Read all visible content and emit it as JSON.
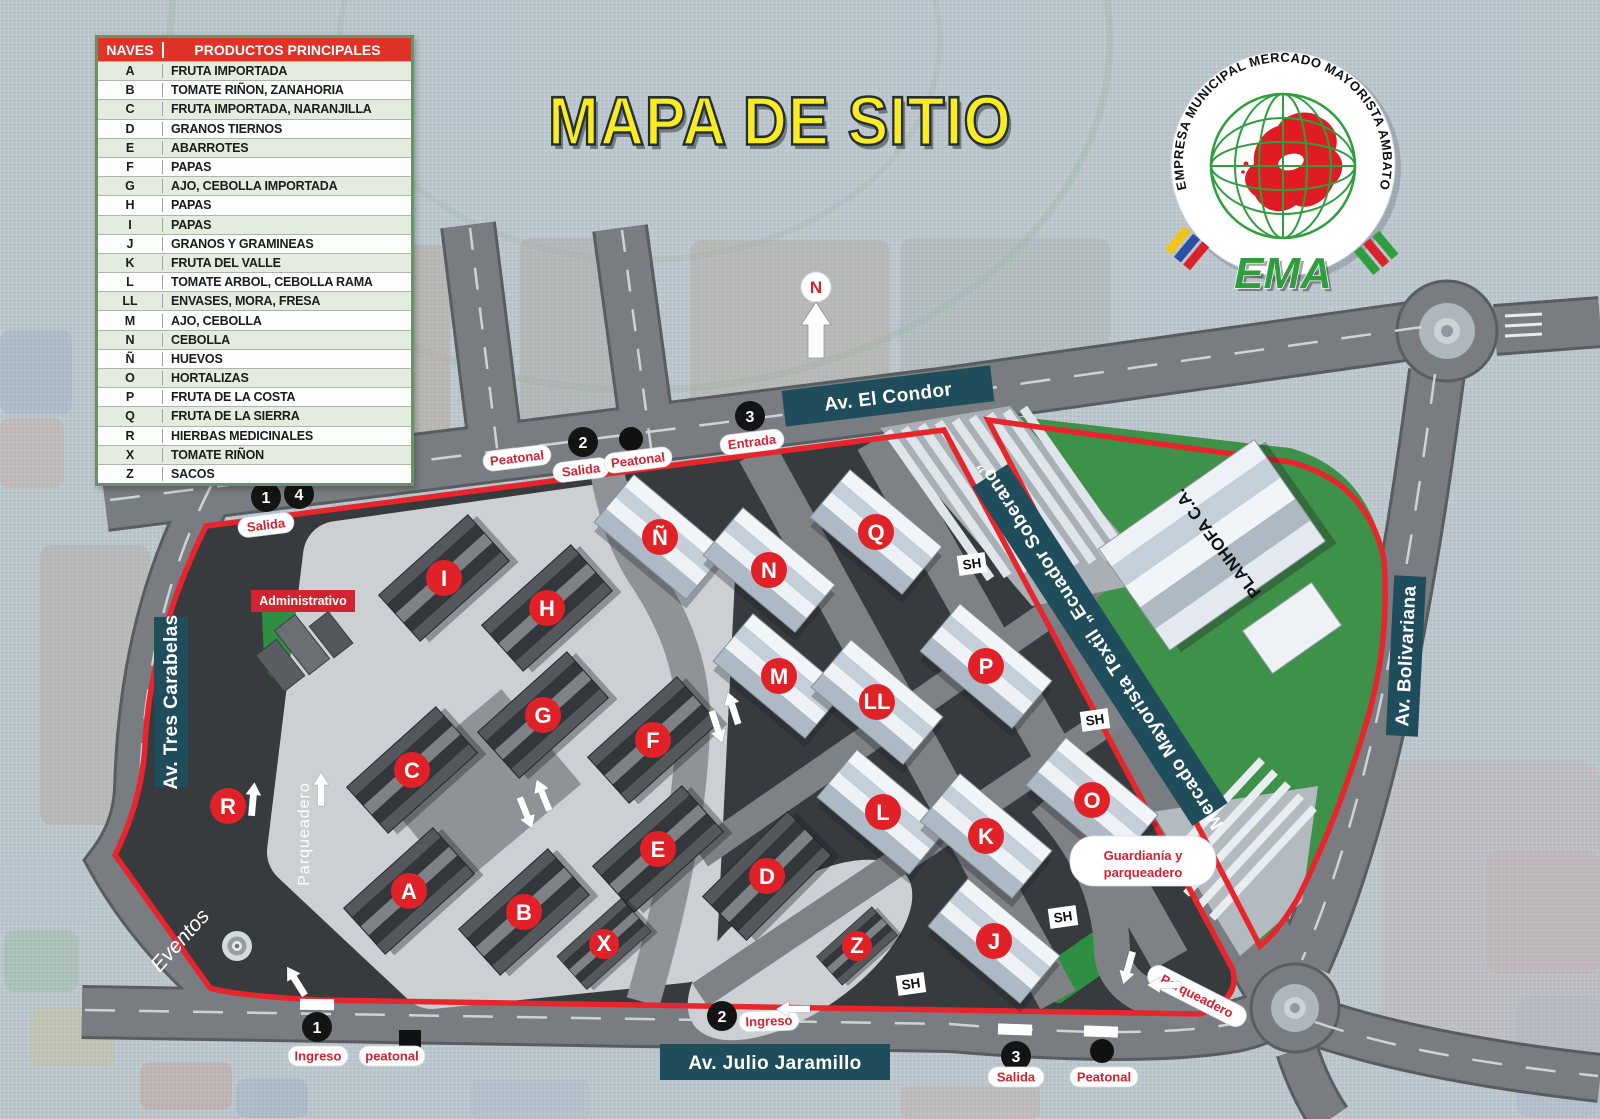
{
  "title": "MAPA DE SITIO",
  "legend": {
    "col_naves": "NAVES",
    "col_productos": "PRODUCTOS PRINCIPALES",
    "rows": [
      {
        "nave": "A",
        "producto": "FRUTA IMPORTADA"
      },
      {
        "nave": "B",
        "producto": "TOMATE RIÑON, ZANAHORIA"
      },
      {
        "nave": "C",
        "producto": "FRUTA IMPORTADA, NARANJILLA"
      },
      {
        "nave": "D",
        "producto": "GRANOS TIERNOS"
      },
      {
        "nave": "E",
        "producto": "ABARROTES"
      },
      {
        "nave": "F",
        "producto": "PAPAS"
      },
      {
        "nave": "G",
        "producto": "AJO, CEBOLLA IMPORTADA"
      },
      {
        "nave": "H",
        "producto": "PAPAS"
      },
      {
        "nave": "I",
        "producto": "PAPAS"
      },
      {
        "nave": "J",
        "producto": "GRANOS Y GRAMINEAS"
      },
      {
        "nave": "K",
        "producto": "FRUTA DEL VALLE"
      },
      {
        "nave": "L",
        "producto": "TOMATE ARBOL, CEBOLLA RAMA"
      },
      {
        "nave": "LL",
        "producto": "ENVASES, MORA, FRESA"
      },
      {
        "nave": "M",
        "producto": "AJO, CEBOLLA"
      },
      {
        "nave": "N",
        "producto": "CEBOLLA"
      },
      {
        "nave": "Ñ",
        "producto": "HUEVOS"
      },
      {
        "nave": "O",
        "producto": "HORTALIZAS"
      },
      {
        "nave": "P",
        "producto": "FRUTA DE LA COSTA"
      },
      {
        "nave": "Q",
        "producto": "FRUTA DE LA SIERRA"
      },
      {
        "nave": "R",
        "producto": "HIERBAS MEDICINALES"
      },
      {
        "nave": "X",
        "producto": "TOMATE RIÑON"
      },
      {
        "nave": "Z",
        "producto": "SACOS"
      }
    ]
  },
  "logo": {
    "ring": "EMPRESA MUNICIPAL MERCADO MAYORISTA AMBATO",
    "name": "EMA"
  },
  "map": {
    "north": "N",
    "streets": {
      "el_condor": "Av. El Condor",
      "tres_carabelas": "Av. Tres Carabelas",
      "bolivariana": "Av. Bolivariana",
      "julio_jaramillo": "Av. Julio Jaramillo"
    },
    "zones": {
      "textil": "Mercado Mayorista Textil „Ecuador Soberano”",
      "planhofa": "PLANHOFA C.A.",
      "administrativo": "Administrativo",
      "eventos": "Eventos",
      "parqueadero": "Parqueadero",
      "guardiania_line1": "Guardianía y",
      "guardiania_line2": "parqueadero",
      "sh": "SH"
    },
    "labels": {
      "salida": "Salida",
      "entrada": "Entrada",
      "ingreso": "Ingreso",
      "peatonal": "Peatonal",
      "peatonal_lc": "peatonal"
    },
    "access": {
      "a1": "1",
      "a2": "2",
      "a3": "3",
      "a4": "4"
    },
    "marker_r": "R",
    "buildings": [
      {
        "letter": "I"
      },
      {
        "letter": "H"
      },
      {
        "letter": "G"
      },
      {
        "letter": "C"
      },
      {
        "letter": "F"
      },
      {
        "letter": "E"
      },
      {
        "letter": "A"
      },
      {
        "letter": "B"
      },
      {
        "letter": "X"
      },
      {
        "letter": "D"
      },
      {
        "letter": "Z"
      },
      {
        "letter": "Ñ"
      },
      {
        "letter": "N"
      },
      {
        "letter": "M"
      },
      {
        "letter": "LL"
      },
      {
        "letter": "L"
      },
      {
        "letter": "Q"
      },
      {
        "letter": "P"
      },
      {
        "letter": "K"
      },
      {
        "letter": "O"
      },
      {
        "letter": "J"
      }
    ],
    "colors": {
      "perimeter_red": "#e8252c",
      "marker_red": "#e02128",
      "banner_teal": "#1f4d5c",
      "zone_green": "#3e9149",
      "road_gray": "#797d81",
      "title_yellow": "#f9ec21",
      "legend_header_red": "#e03228"
    }
  }
}
